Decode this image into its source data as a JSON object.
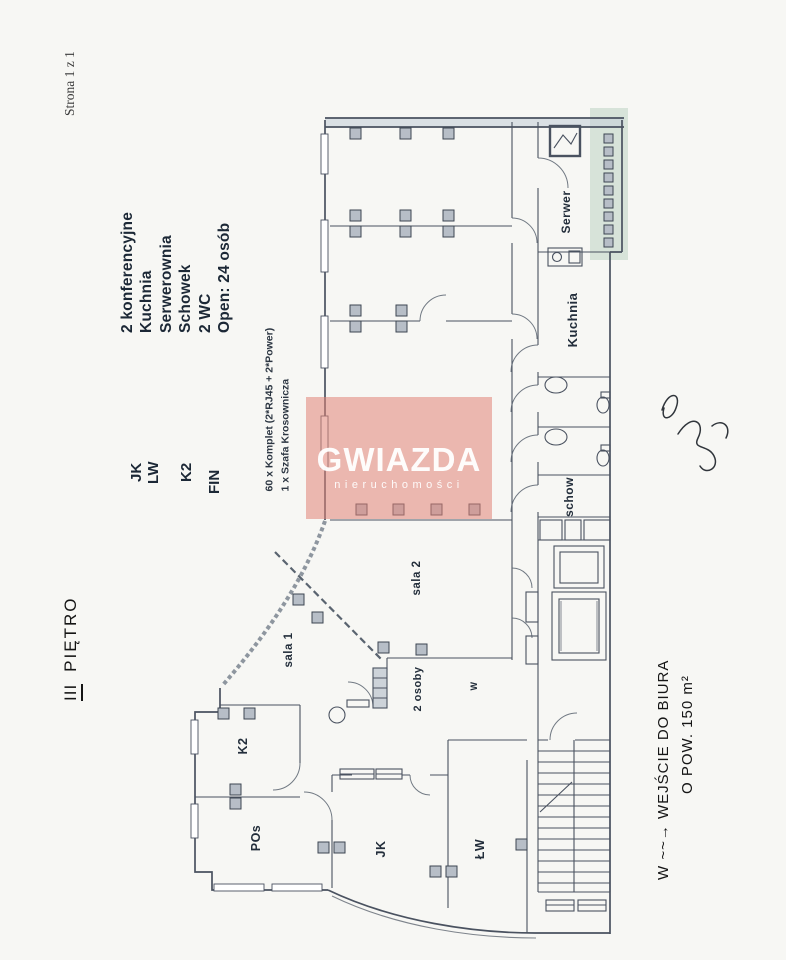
{
  "scan": {
    "page_indicator": "Strona 1 z 1",
    "floor_title": {
      "numeral": "III",
      "word": "PIĘTRO"
    },
    "legend": {
      "rooms": [
        "2 konferencyjne",
        "Kuchnia",
        "Serwerownia",
        "Schowek",
        "2 WC",
        "Open: 24 osób"
      ],
      "codes": [
        "JK",
        "LW",
        "K2",
        "FIN"
      ],
      "equipment": [
        "60 x Komplet (2*RJ45 + 2*Power)",
        "1 x Szafa Krosownicza"
      ]
    },
    "watermark": {
      "brand": "GWIAZDA",
      "subtitle": "nieruchomości"
    },
    "plan_labels": {
      "serwer": "Serwer",
      "kuchnia": "Kuchnia",
      "schow": "schow",
      "sala1": "sala 1",
      "sala2": "sala 2",
      "two_people": "2 osoby",
      "w": "W",
      "k2": "K2",
      "pos": "POs",
      "jk": "JK",
      "lw": "ŁW"
    },
    "note": {
      "line1": "W ~~→ WEJŚCIE DO BIURA",
      "line2": "O POW. 150 m²"
    },
    "colors": {
      "watermark_bg": "#e28376",
      "watermark_text": "#ffffff",
      "ink": "#4a5260",
      "highlight_green": "#8fb79d",
      "paper": "#f7f7f4"
    }
  }
}
